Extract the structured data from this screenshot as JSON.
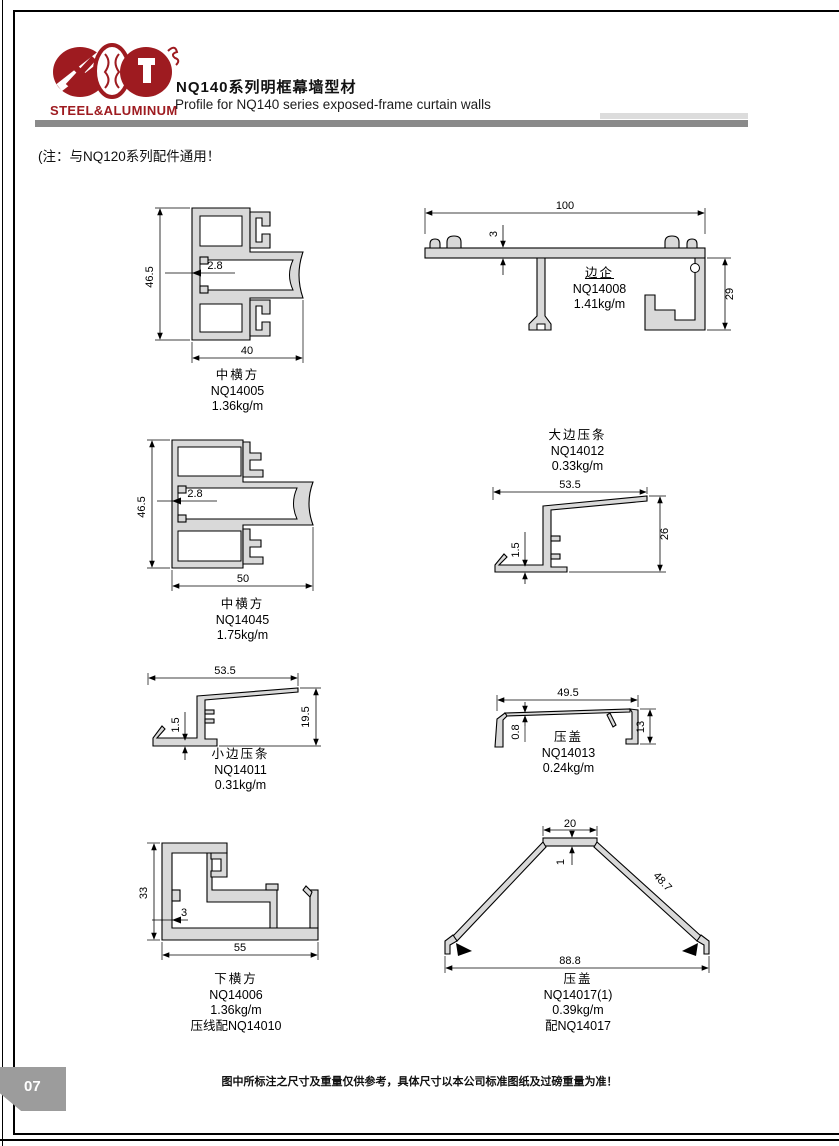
{
  "header": {
    "logo_text": "STEEL&ALUMINUM",
    "title_zh": "NQ140系列明框幕墙型材",
    "title_en": "Profile for NQ140 series exposed-frame curtain walls"
  },
  "note": "(注：与NQ120系列配件通用！",
  "footer": "图中所标注之尺寸及重量仅供参考，具体尺寸以本公司标准图纸及过磅重量为准！",
  "page_number": "07",
  "colors": {
    "accent": "#9e1b20",
    "profile_fill": "#d9d9d9",
    "divider_bar": "#8a8a8a"
  },
  "profiles": [
    {
      "name": "中横方",
      "code": "NQ14005",
      "weight": "1.36kg/m",
      "dims": {
        "height": "46.5",
        "thickness": "2.8",
        "width": "40"
      }
    },
    {
      "name": "边企",
      "code": "NQ14008",
      "weight": "1.41kg/m",
      "dims": {
        "width": "100",
        "thickness": "3",
        "height": "29"
      }
    },
    {
      "name": "中横方",
      "code": "NQ14045",
      "weight": "1.75kg/m",
      "dims": {
        "height": "46.5",
        "thickness": "2.8",
        "width": "50"
      }
    },
    {
      "name": "大边压条",
      "code": "NQ14012",
      "weight": "0.33kg/m",
      "dims": {
        "width": "53.5",
        "thickness": "1.5",
        "height": "26"
      }
    },
    {
      "name": "小边压条",
      "code": "NQ14011",
      "weight": "0.31kg/m",
      "dims": {
        "width": "53.5",
        "thickness": "1.5",
        "height": "19.5"
      }
    },
    {
      "name": "压盖",
      "code": "NQ14013",
      "weight": "0.24kg/m",
      "dims": {
        "width": "49.5",
        "thickness": "0.8",
        "height": "13"
      }
    },
    {
      "name": "下横方",
      "code": "NQ14006",
      "weight": "1.36kg/m",
      "extra": "压线配NQ14010",
      "dims": {
        "height": "33",
        "thickness": "3",
        "width": "55"
      }
    },
    {
      "name": "压盖",
      "code": "NQ14017(1)",
      "weight": "0.39kg/m",
      "extra": "配NQ14017",
      "dims": {
        "top_width": "20",
        "thickness": "1",
        "slope": "48.7",
        "width": "88.8"
      }
    }
  ]
}
